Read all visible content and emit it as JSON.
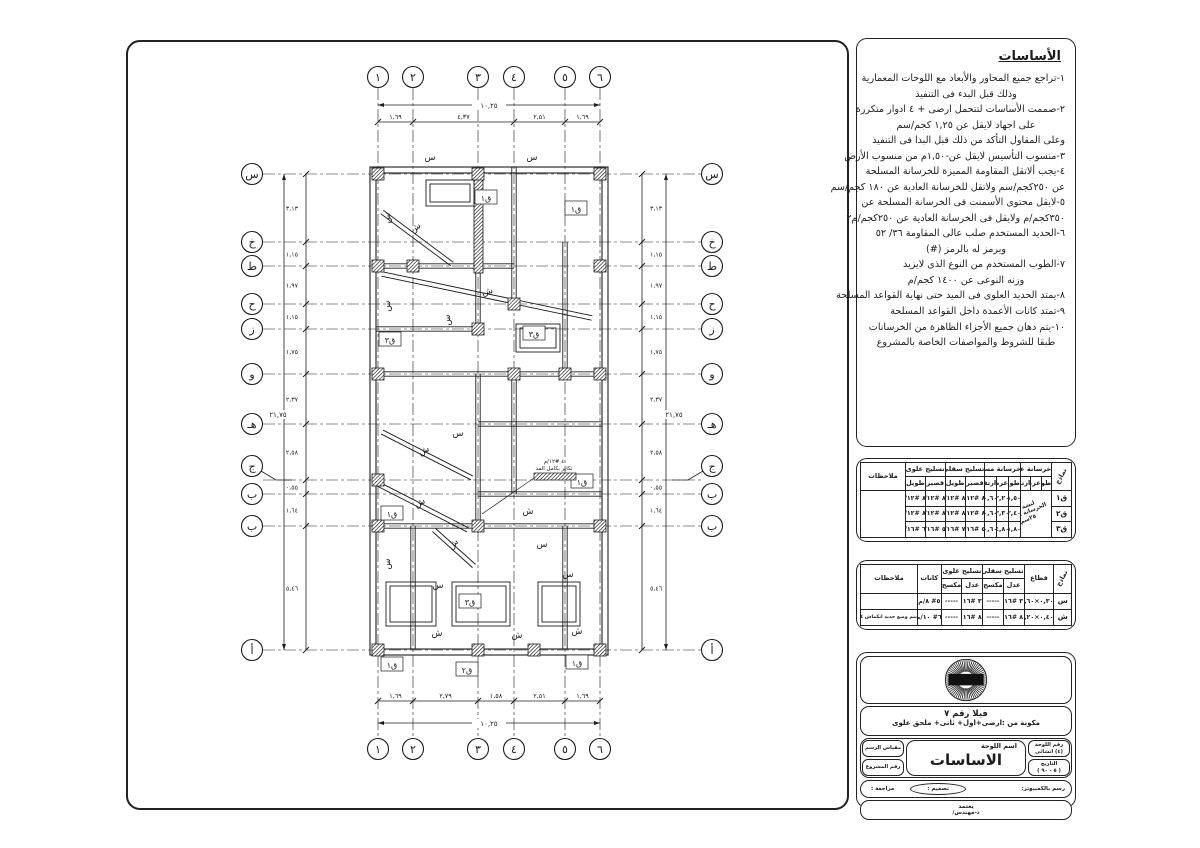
{
  "plan": {
    "grid_cols": [
      "١",
      "٢",
      "٣",
      "٤",
      "٥",
      "٦"
    ],
    "grid_rows": [
      "س",
      "خ",
      "ط",
      "ح",
      "ز",
      "و",
      "هـ",
      "ج",
      "ب",
      "ب",
      "أ"
    ],
    "dim_top_total": "١٠,٢٥",
    "dim_top_segments": [
      "١,٦٩",
      "٤,٣٧",
      "٢,٥١",
      "١,٦٩"
    ],
    "dim_bottom_total": "١٠,٢٥",
    "dim_bottom_segments": [
      "١,٦٩",
      "٢,٧٩",
      "١,٥٨",
      "٢,٥١",
      "١,٦٩"
    ],
    "dim_left_segments": [
      "٣,١٣",
      "١,١٥",
      "١,٩٧",
      "١,١٥",
      "١,٧٥",
      "٢,٣٧",
      "٢,٥٨",
      "٠,٥٥",
      "١,٦٤",
      "٥,٤٦"
    ],
    "dim_side_total": "٢١,٧٥",
    "label_semelle": "س",
    "label_shadad": "ش",
    "footing_labels": {
      "f1": "ق١",
      "f2": "ق٢",
      "f3": "ق٣"
    },
    "annotation_line1": "٤ #١٢/م",
    "annotation_line2": "تكاير بكامل المد"
  },
  "notes": {
    "title": "الأساسات",
    "lines": [
      "١-تراجع جميع المحاور والأبعاد مع اللوحات المعمارية",
      "وذلك قبل البدء فى التنفيذ",
      "٢-صممت الأساسات لتتحمل ارضى + ٤ ادوار متكررة",
      "على اجهاد لايقل عن ١,٢٥ كجم/سم",
      "وعلى المقاول التأكد من ذلك قبل البدا فى التنفيذ",
      "٣-منسوب التأسيس لايقل عن-١,٥٠م من منسوب الأرض",
      "٤-يجب ألاتقل المقاومة المميزة للخرسانة المسلحة",
      "عن ٢٥٠كجم/سم ولاتقل للخرسانة العادية عن ١٨٠ كجم/سم",
      "٥-لايقل محتوى الأسمنت فى الخرسانة المسلحة عن",
      "٣٥٠كجم/م ولايقل فى الخرسانة العادية عن ٢٥٠كجم/م٢",
      "٦-الحديد المستخدم صلب عالى المقاومة ٣٦/ ٥٢",
      "ويرمز له بالرمز (#)",
      "٧-الطوب المستخدم من النوع الذى لايزيد",
      "وزنه النوعى عن ١٤٠٠ كجم/م",
      "٨-يمتد الحديد العلوى فى الميد حتى نهاية القواعد المسلحة",
      "٩-تمتد كانات الأعمدة داخل القواعد المسلحة",
      "١٠-يتم دهان جميع الأجزاء الظاهرة من الخرسانات",
      "طبقا للشروط والمواصفات الخاصة بالمشروع"
    ]
  },
  "footings_table": {
    "col_models": "نماذج",
    "group_plain": "خرسانة عادية",
    "group_rc": "خرسانة مسلحة",
    "group_bottom": "تسليح سفلى",
    "group_top": "تسليح علوى",
    "col_notes": "ملاحظات",
    "sub_len": "طول",
    "sub_wid": "عرض",
    "sub_ht": "ارتفاع",
    "sub_short": "قصير",
    "sub_long": "طويل",
    "plain_note": "لبشة من الخرسانة العادية ٢٥سم",
    "rows": [
      {
        "name": "ق١",
        "len": "١,٥٠",
        "wid": "٢,٢٠",
        "ht": "٠,٦٠",
        "bs": "٨ #١٢/م",
        "bl": "٨ #١٢/م",
        "ts": "٨ #١٢/م",
        "tl": "٨ #١٢/م",
        "notes": ""
      },
      {
        "name": "ق٢",
        "len": "٢,٤٠",
        "wid": "٢,٣٠",
        "ht": "٠,٦٠",
        "bs": "٨ #١٢/م",
        "bl": "٨ #١٢/م",
        "ts": "٨ #١٢/م",
        "tl": "٨ #١٢/م",
        "notes": ""
      },
      {
        "name": "ق٣",
        "len": "١,٨٠",
        "wid": "٤,٨٠",
        "ht": "٠,٦٠",
        "bs": "٥ #١٦/م",
        "bl": "٧ #١٦/م",
        "ts": "٥ #١٦/م",
        "tl": "٦ #١٦/م",
        "notes": ""
      }
    ]
  },
  "semelles_table": {
    "col_models": "نماذج",
    "col_section": "قطاع",
    "group_bottom": "تسليح سفلى",
    "group_top": "تسليح علوى",
    "col_stirrups": "كانات",
    "col_notes": "ملاحظات",
    "sub_straight": "عدل",
    "sub_bent": "مكسح",
    "rows": [
      {
        "name": "س",
        "section": "٠,٣٠×٠,٦٠",
        "bs": "٣ #١٦",
        "bb": "-----",
        "ts": "٣ #١٦",
        "tb": "-----",
        "st": "٥# ٨/م",
        "notes": ""
      },
      {
        "name": "ش",
        "section": "٠,٤٠×١,٢٠",
        "bs": "٨ #١٦",
        "bb": "-----",
        "ts": "٨ #١٦",
        "tb": "-----",
        "st": "٦# ١٠/م",
        "notes": "يتم وضع حديد انكماش ٤#١٢/م"
      }
    ]
  },
  "title_block": {
    "villa_line1": "فيلا رقم ٧",
    "villa_line2": "مكونة من :ارضى+اول+ ثانى+ ملحق علوى",
    "sheet_no_label": "رقم اللوحة",
    "sheet_no_value": "(٤) انشائى",
    "date_label": "التاريخ",
    "date_value": "( ٥ - ٩٠ )",
    "scale_label": "مقياس الرسم",
    "project_no_label": "رقم المشروع",
    "sheet_name_label": "اسم اللوحة",
    "sheet_name": "الاساسات",
    "cad_label": "رسم بالكمبيوتر:",
    "design_label": "تصميم :",
    "review_label": "مراجعة :",
    "approve_label": "يعتمد",
    "engineer_label": "د-مهندس/"
  }
}
